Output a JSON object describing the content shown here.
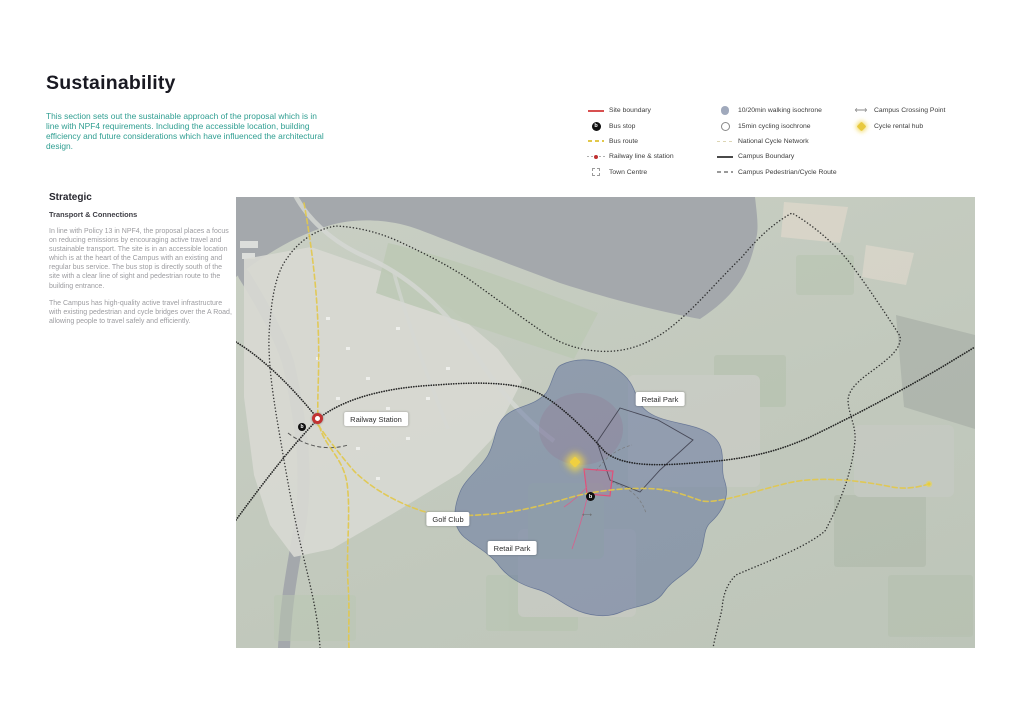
{
  "header": {
    "title": "Sustainability",
    "intro": "This section sets out the sustainable approach of the proposal which is in line with NPF4 requirements. Including the accessible location, building efficiency and future considerations which have influenced the architectural design."
  },
  "legend": {
    "col1": [
      {
        "label": "Site boundary",
        "icon": "site-boundary-line"
      },
      {
        "label": "Bus stop",
        "icon": "bus-stop-dot"
      },
      {
        "label": "Bus route",
        "icon": "bus-route-dash"
      },
      {
        "label": "Railway line & station",
        "icon": "railway-station-marker"
      },
      {
        "label": "Town Centre",
        "icon": "town-centre-dashed-box"
      }
    ],
    "col2": [
      {
        "label": "10/20min walking isochrone",
        "icon": "walking-isochrone-circle"
      },
      {
        "label": "15min cycling isochrone",
        "icon": "cycling-isochrone-ring"
      },
      {
        "label": "National Cycle Network",
        "icon": "ncn-dash"
      },
      {
        "label": "Campus Boundary",
        "icon": "campus-boundary-line"
      },
      {
        "label": "Campus Pedestrian/Cycle Route",
        "icon": "pedestrian-route-dash"
      }
    ],
    "col3": [
      {
        "label": "Campus Crossing Point",
        "icon": "crossing-point-arrow"
      },
      {
        "label": "Cycle rental hub",
        "icon": "cycle-hub-diamond"
      }
    ]
  },
  "strategic": {
    "heading": "Strategic",
    "subheading": "Transport & Connections",
    "paragraph1": "In line with Policy 13 in NPF4, the proposal places a focus on reducing emissions by encouraging active travel and sustainable transport. The site is in an accessible location which is at the heart of the Campus with an existing and regular bus service. The bus stop is directly south of the site with a clear line of sight and pedestrian route to the building entrance.",
    "paragraph2": "The Campus has high-quality active travel infrastructure with existing pedestrian and cycle bridges over the A Road, allowing people to travel safely and efficiently."
  },
  "map": {
    "labels": {
      "railway_station": "Railway Station",
      "retail_park_north": "Retail Park",
      "golf_club": "Golf Club",
      "retail_park_south": "Retail Park"
    }
  },
  "icons": {
    "bus_stop_glyph": "b",
    "crossing_point_glyph": "⟷"
  },
  "colors": {
    "accent_teal": "#2f9e91",
    "site_boundary_red": "#d85050",
    "bus_route_yellow": "#e2c84a",
    "walking_isochrone_blue": "#5a6fa8",
    "railway_dot_black": "#1a1a1a",
    "cycle_hub_yellow": "#e8c93e",
    "water_grey": "#a4a8ac",
    "label_text": "#2e2e2e"
  }
}
